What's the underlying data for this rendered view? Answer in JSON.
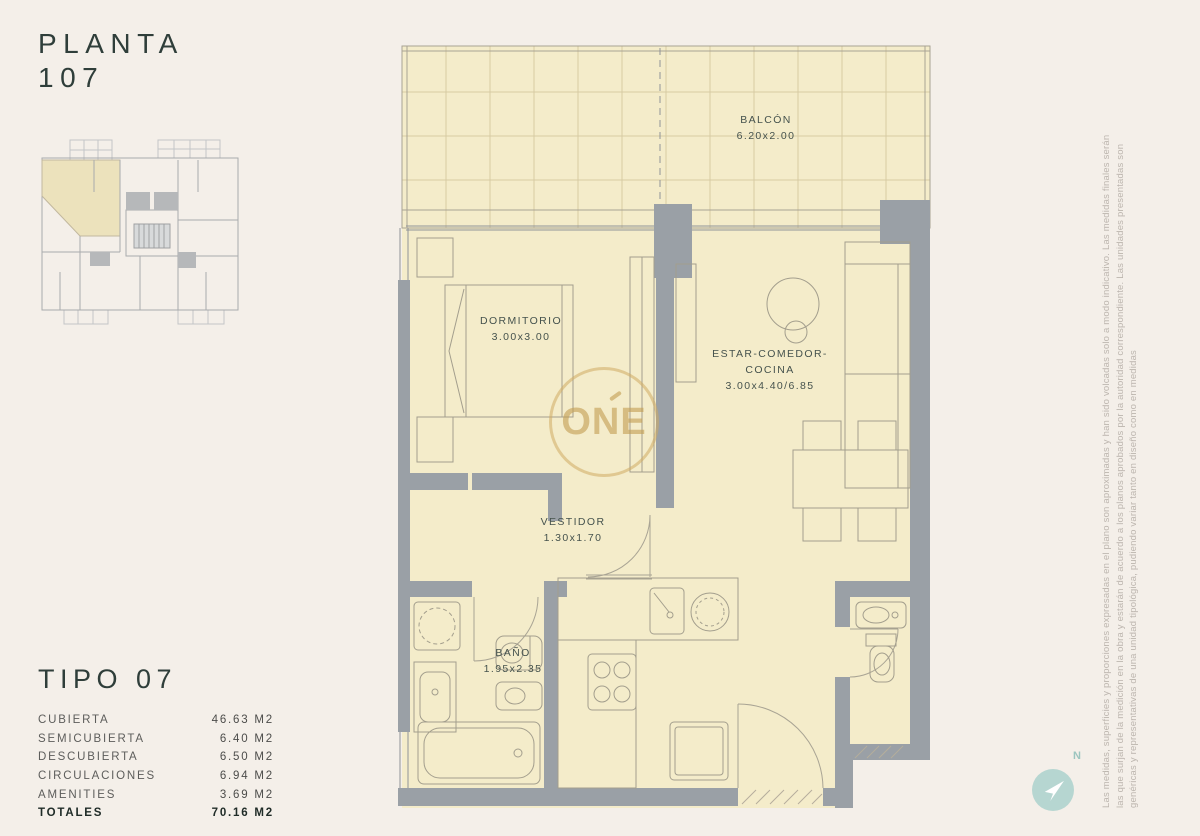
{
  "header": {
    "title_line1": "PLANTA",
    "title_line2": "107"
  },
  "plan": {
    "rooms": [
      {
        "name": "BALCÓN",
        "dims": "6.20x2.00"
      },
      {
        "name": "DORMITORIO",
        "dims": "3.00x3.00"
      },
      {
        "name": "ESTAR-COMEDOR-",
        "name2": "COCINA",
        "dims": "3.00x4.40/6.85"
      },
      {
        "name": "VESTIDOR",
        "dims": "1.30x1.70"
      },
      {
        "name": "BAÑO",
        "dims": "1.95x2.35"
      }
    ],
    "watermark": "ONE"
  },
  "type_summary": {
    "title": "TIPO 07",
    "rows": [
      {
        "label": "CUBIERTA",
        "value": "46.63 M2"
      },
      {
        "label": "SEMICUBIERTA",
        "value": "6.40 M2"
      },
      {
        "label": "DESCUBIERTA",
        "value": "6.50 M2"
      },
      {
        "label": "CIRCULACIONES",
        "value": "6.94 M2"
      },
      {
        "label": "AMENITIES",
        "value": "3.69 M2"
      },
      {
        "label": "TOTALES",
        "value": "70.16 M2"
      }
    ]
  },
  "disclaimer": {
    "line1": "Las medidas, superficies y proporciones expresadas en el plano son aproximadas y han sido volcadas solo a modo indicativo. Las medidas finales serán",
    "line2": "las que surjan de la medición en la obra y estarán de acuerdo a los planos aprobados por la autoridad correspondiente. Las unidades presentadas son",
    "line3": "genéricas y representativas de una unidad tipológica, pudiendo variar tanto en diseño como en medidas"
  },
  "compass": {
    "label": "N"
  },
  "colors": {
    "page_bg": "#f4efe9",
    "plan_fill": "#f4ecca",
    "wall_gray": "#9aa0a6",
    "brand_gold": "#c7a25d",
    "compass_teal": "#b6d6d1",
    "text_dark": "#2f3e3a"
  }
}
